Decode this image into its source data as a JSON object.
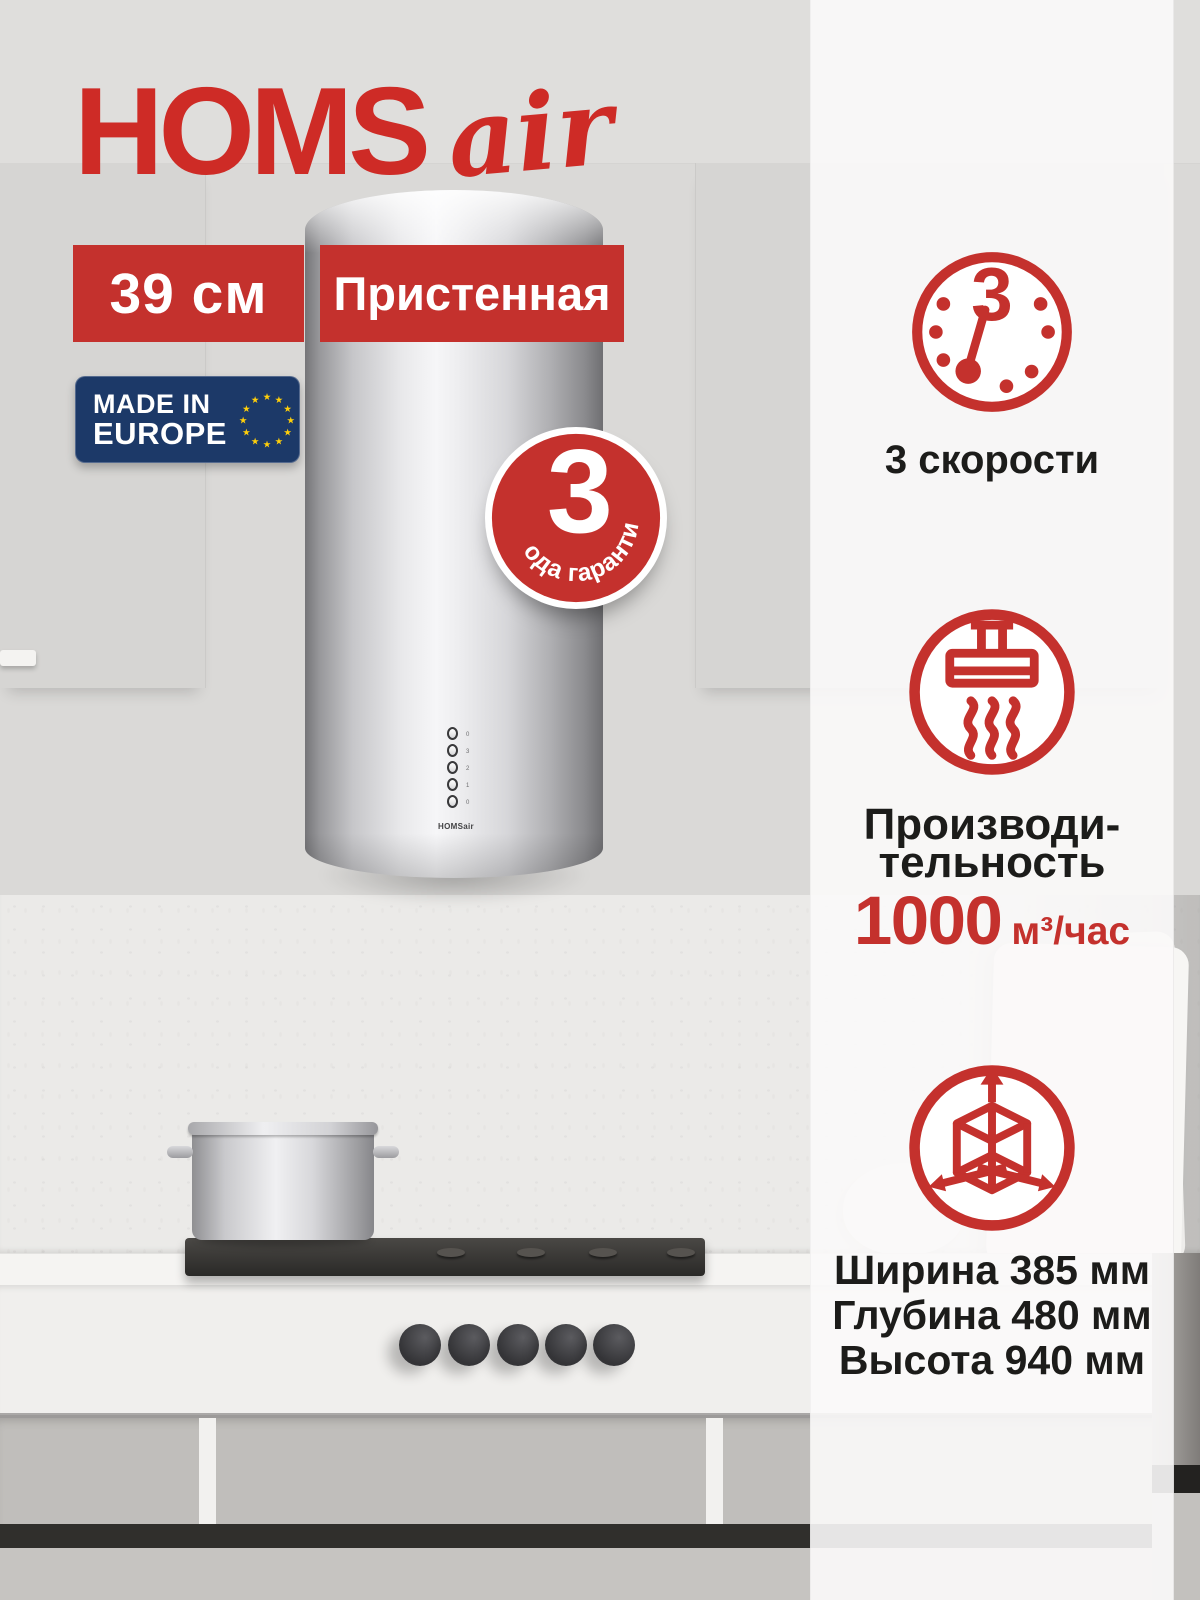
{
  "header": {
    "logo_part1": "HOMS",
    "logo_part2": "air"
  },
  "badges": {
    "size": "39 см",
    "mount": "Пристенная",
    "made_in": {
      "line1": "MADE IN",
      "line2": "EUROPE"
    },
    "warranty": {
      "number": "3",
      "text": "года гарантии"
    }
  },
  "sidebar": {
    "speeds": {
      "icon": "clock-3-icon",
      "clock_number": "3",
      "label": "3 скорости"
    },
    "performance": {
      "icon": "hood-steam-icon",
      "label_line1": "Производи-",
      "label_line2": "тельность",
      "value": "1000",
      "unit": "м³/час"
    },
    "dimensions": {
      "icon": "dimensions-cube-icon",
      "line1": "Ширина 385 мм",
      "line2": "Глубина 480 мм",
      "line3": "Высота 940 мм"
    }
  },
  "appliance": {
    "panel_logo": "HOMSair",
    "buttons": [
      "0",
      "3",
      "2",
      "1",
      "0"
    ]
  },
  "colors": {
    "brand_red": "#C4312D",
    "logo_red": "#CE2B26",
    "navy": "#1C3968",
    "star_yellow": "#FFCF0A",
    "text_dark": "#1C1C1A"
  }
}
